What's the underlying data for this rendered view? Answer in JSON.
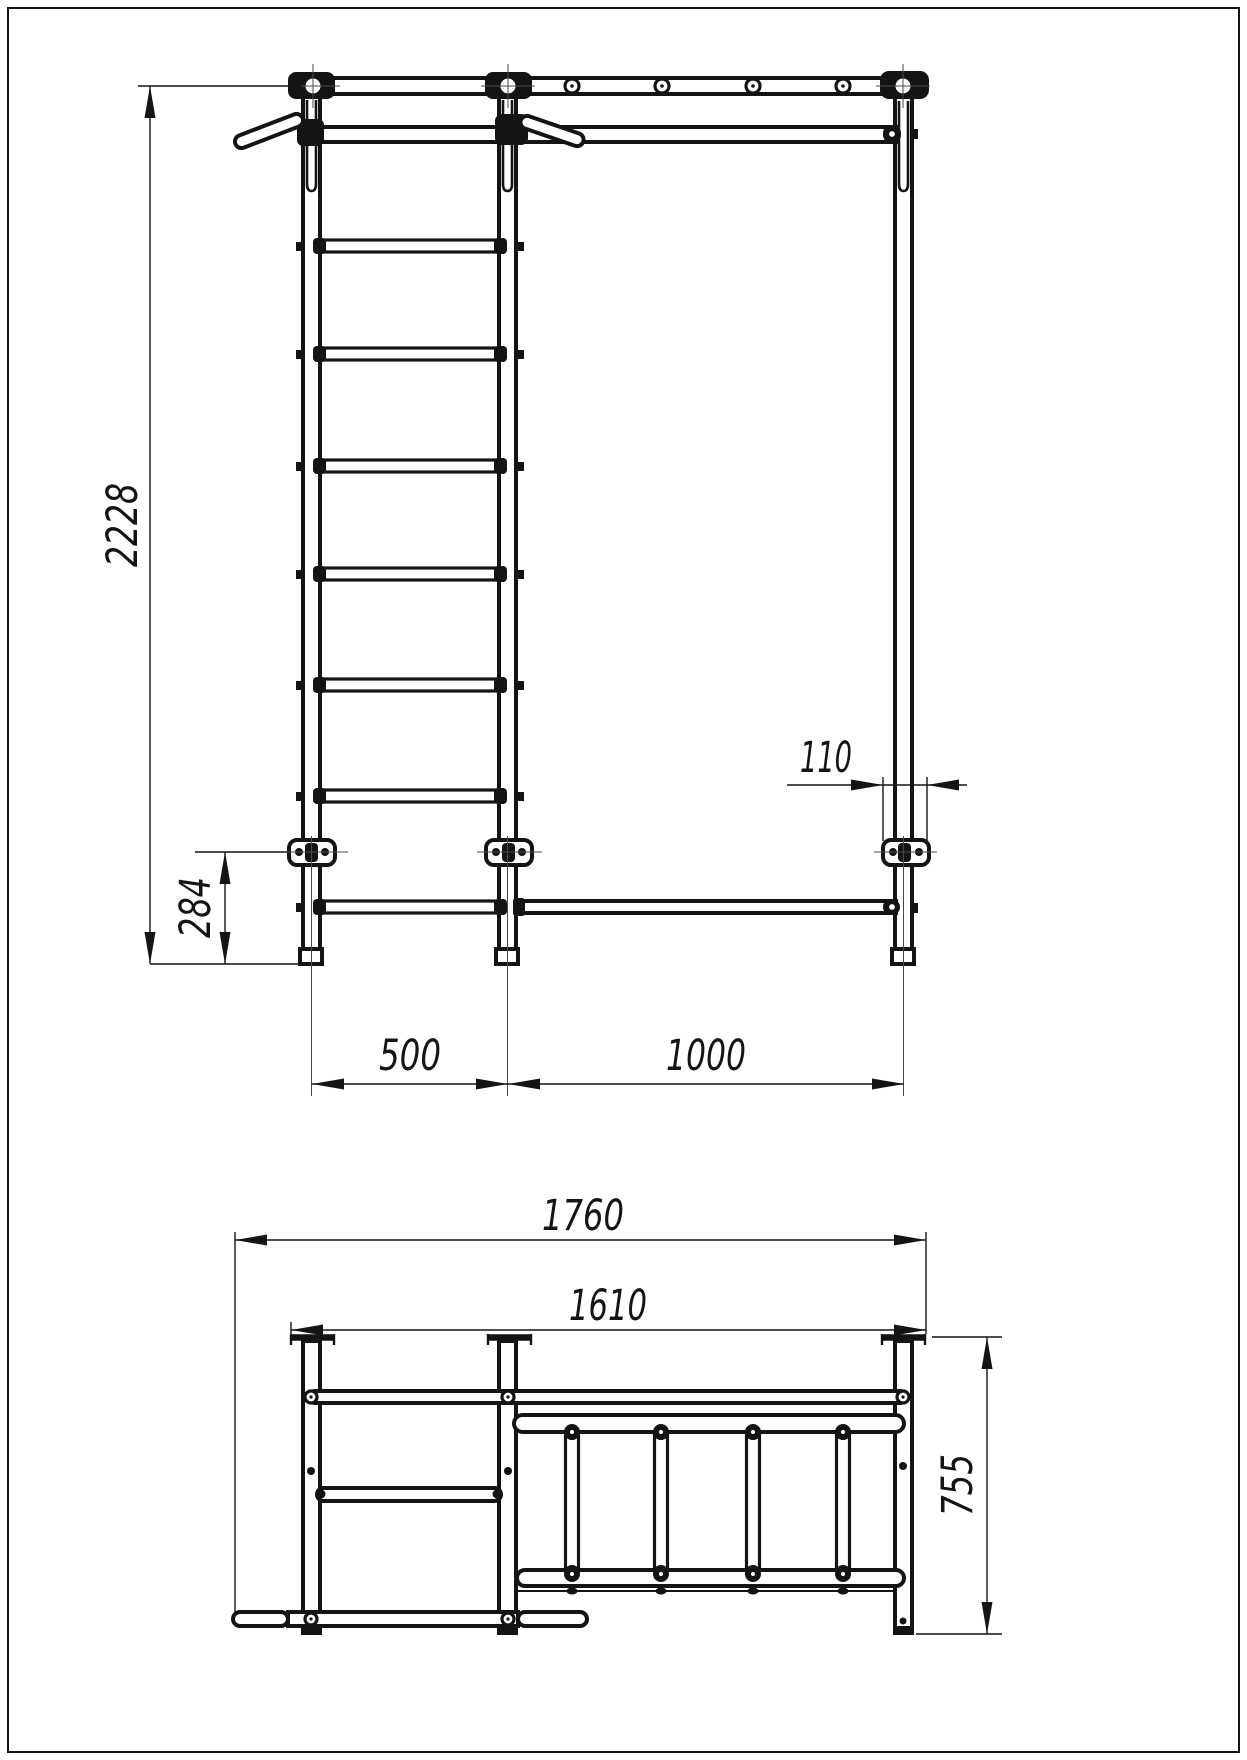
{
  "sheet": {
    "background_color": "#ffffff",
    "line_color": "#141414",
    "content": "technical drawing, two orthographic views of a wall-bar / pull-up ladder structure"
  },
  "front_view": {
    "name": "front elevation",
    "features": [
      "three vertical posts",
      "top beam with four rung holes",
      "seven-rung ladder in left bay",
      "long pull-up bar",
      "two angled hand grips",
      "three wall anchor plates",
      "foot caps"
    ],
    "dimensions": {
      "overall_height": "2228",
      "anchor_to_floor": "284",
      "anchor_plate_width": "110",
      "left_bay_width": "500",
      "right_bay_width": "1000"
    }
  },
  "top_view": {
    "name": "plan view",
    "features": [
      "three wall plates",
      "three horizontal beams",
      "monkey-ladder with four rungs",
      "pull-up bar",
      "floor support tube"
    ],
    "dimensions": {
      "overall_length": "1760",
      "frame_length": "1610",
      "depth": "755"
    }
  }
}
